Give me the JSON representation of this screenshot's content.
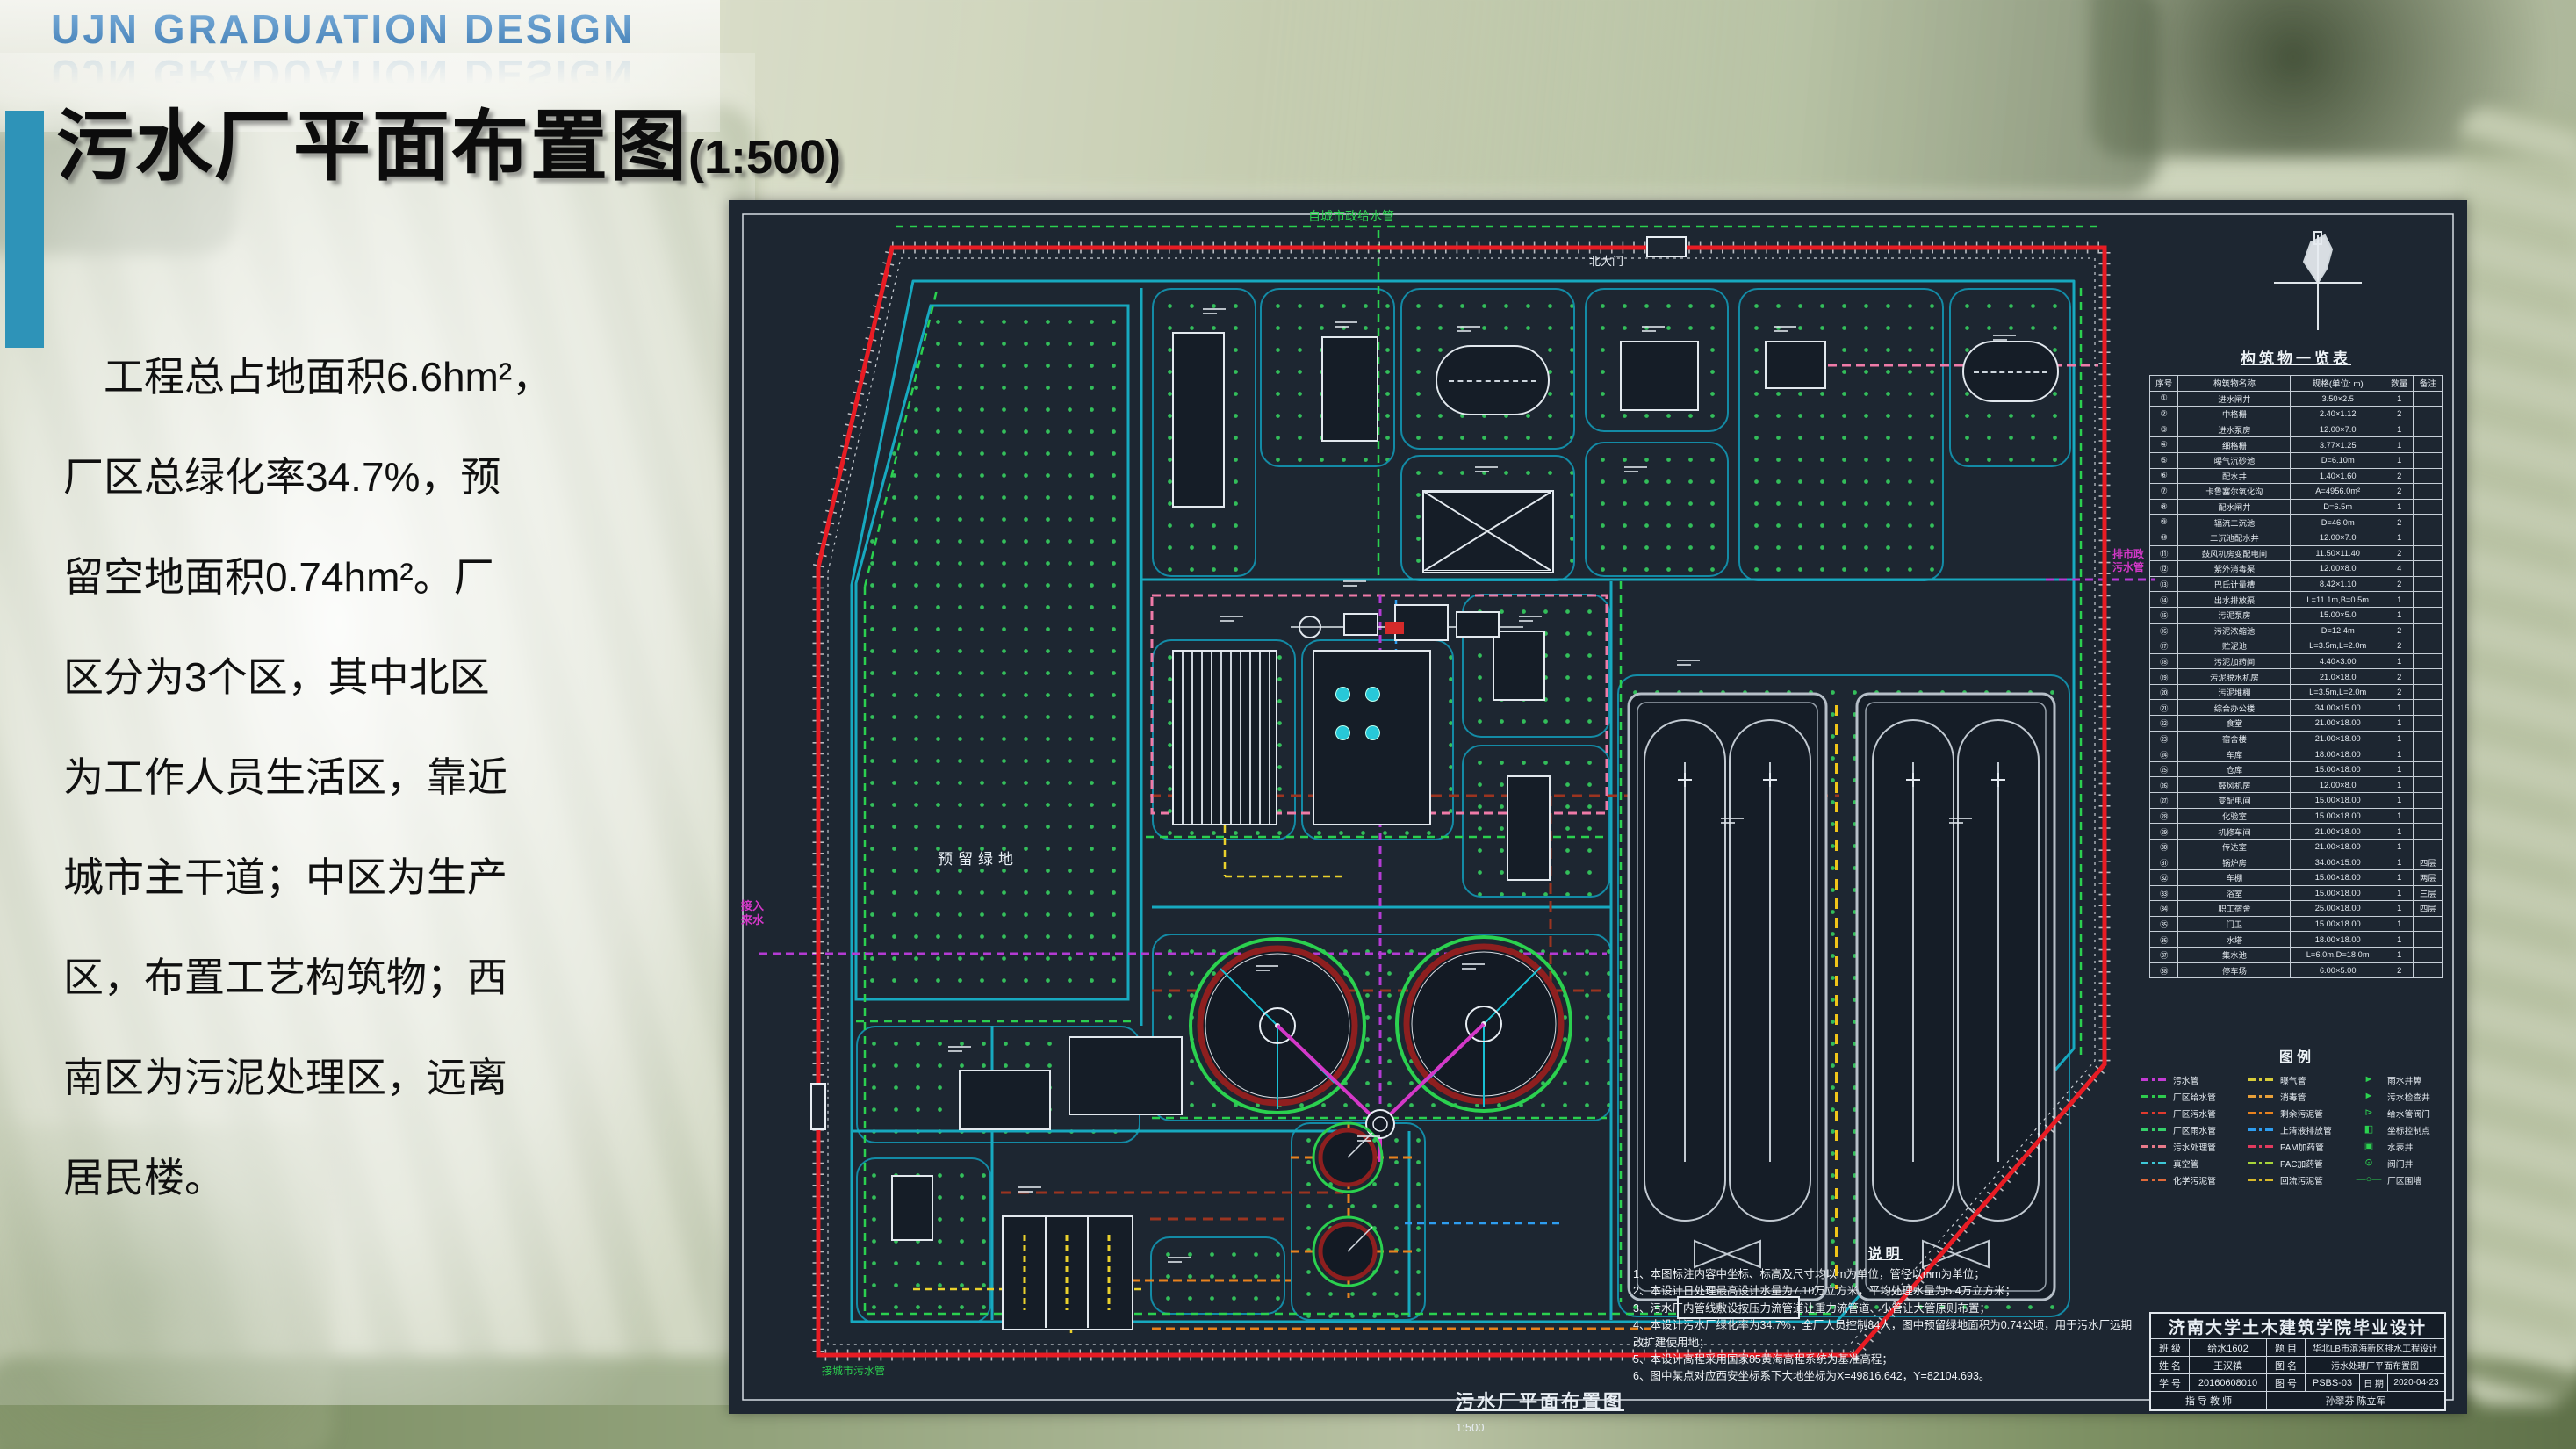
{
  "slide": {
    "header": "UJN GRADUATION DESIGN",
    "title": "污水厂平面布置图",
    "title_scale": "(1:500)",
    "paragraph_lines": [
      "　工程总占地面积6.6hm²，",
      "厂区总绿化率34.7%，预",
      "留空地面积0.74hm²。厂",
      "区分为3个区，其中北区",
      "为工作人员生活区，靠近",
      "城市主干道；中区为生产",
      "区，布置工艺构筑物；西",
      "南区为污泥处理区，远离",
      "居民楼。"
    ]
  },
  "drawing": {
    "labels": {
      "reserved_green": "预留绿地",
      "north_gate": "北大门",
      "inflow": "接入\n来水",
      "outfall": "排市政\n污水管",
      "top_pipe": "自城市政给水管",
      "bottom_pipe": "接城市污水管",
      "bottom_title": "污水厂平面布置图",
      "bottom_scale": "1:500"
    },
    "table": {
      "title": "构筑物一览表",
      "headers": [
        "序号",
        "构筑物名称",
        "规格(单位: m)",
        "数量",
        "备注"
      ],
      "rows": [
        [
          "①",
          "进水闸井",
          "3.50×2.5",
          "1",
          ""
        ],
        [
          "②",
          "中格栅",
          "2.40×1.12",
          "2",
          ""
        ],
        [
          "③",
          "进水泵房",
          "12.00×7.0",
          "1",
          ""
        ],
        [
          "④",
          "细格栅",
          "3.77×1.25",
          "1",
          ""
        ],
        [
          "⑤",
          "曝气沉砂池",
          "D=6.10m",
          "1",
          ""
        ],
        [
          "⑥",
          "配水井",
          "1.40×1.60",
          "2",
          ""
        ],
        [
          "⑦",
          "卡鲁塞尔氧化沟",
          "A=4956.0m²",
          "2",
          ""
        ],
        [
          "⑧",
          "配水闸井",
          "D=6.5m",
          "1",
          ""
        ],
        [
          "⑨",
          "辐流二沉池",
          "D=46.0m",
          "2",
          ""
        ],
        [
          "⑩",
          "二沉池配水井",
          "12.00×7.0",
          "1",
          ""
        ],
        [
          "⑪",
          "鼓风机房变配电间",
          "11.50×11.40",
          "2",
          ""
        ],
        [
          "⑫",
          "紫外消毒渠",
          "12.00×8.0",
          "4",
          ""
        ],
        [
          "⑬",
          "巴氏计量槽",
          "8.42×1.10",
          "2",
          ""
        ],
        [
          "⑭",
          "出水排放渠",
          "L=11.1m,B=0.5m",
          "1",
          ""
        ],
        [
          "⑮",
          "污泥泵房",
          "15.00×5.0",
          "1",
          ""
        ],
        [
          "⑯",
          "污泥浓缩池",
          "D=12.4m",
          "2",
          ""
        ],
        [
          "⑰",
          "贮泥池",
          "L=3.5m,L=2.0m",
          "2",
          ""
        ],
        [
          "⑱",
          "污泥加药间",
          "4.40×3.00",
          "1",
          ""
        ],
        [
          "⑲",
          "污泥脱水机房",
          "21.0×18.0",
          "2",
          ""
        ],
        [
          "⑳",
          "污泥堆棚",
          "L=3.5m,L=2.0m",
          "2",
          ""
        ],
        [
          "㉑",
          "综合办公楼",
          "34.00×15.00",
          "1",
          ""
        ],
        [
          "㉒",
          "食堂",
          "21.00×18.00",
          "1",
          ""
        ],
        [
          "㉓",
          "宿舍楼",
          "21.00×18.00",
          "1",
          ""
        ],
        [
          "㉔",
          "车库",
          "18.00×18.00",
          "1",
          ""
        ],
        [
          "㉕",
          "仓库",
          "15.00×18.00",
          "1",
          ""
        ],
        [
          "㉖",
          "鼓风机房",
          "12.00×8.0",
          "1",
          ""
        ],
        [
          "㉗",
          "变配电间",
          "15.00×18.00",
          "1",
          ""
        ],
        [
          "㉘",
          "化验室",
          "15.00×18.00",
          "1",
          ""
        ],
        [
          "㉙",
          "机修车间",
          "21.00×18.00",
          "1",
          ""
        ],
        [
          "㉚",
          "传达室",
          "21.00×18.00",
          "1",
          ""
        ],
        [
          "㉛",
          "锅炉房",
          "34.00×15.00",
          "1",
          "四层"
        ],
        [
          "㉜",
          "车棚",
          "15.00×18.00",
          "1",
          "两层"
        ],
        [
          "㉝",
          "浴室",
          "15.00×18.00",
          "1",
          "三层"
        ],
        [
          "㉞",
          "职工宿舍",
          "25.00×18.00",
          "1",
          "四层"
        ],
        [
          "㉟",
          "门卫",
          "15.00×18.00",
          "1",
          ""
        ],
        [
          "㊱",
          "水塔",
          "18.00×18.00",
          "1",
          ""
        ],
        [
          "㊲",
          "集水池",
          "L=6.0m,D=18.0m",
          "1",
          ""
        ],
        [
          "㊳",
          "停车场",
          "6.00×5.00",
          "2",
          ""
        ]
      ]
    },
    "legend": {
      "title": "图例",
      "col1": [
        {
          "label": "污水管",
          "color": "#c43bd4"
        },
        {
          "label": "厂区给水管",
          "color": "#2ecc4e"
        },
        {
          "label": "厂区污水管",
          "color": "#e03a2e"
        },
        {
          "label": "厂区雨水管",
          "color": "#35d06a"
        },
        {
          "label": "污水处理管",
          "color": "#e87a8a"
        },
        {
          "label": "真空管",
          "color": "#3ec8d8"
        },
        {
          "label": "化学污泥管",
          "color": "#e06a3a"
        }
      ],
      "col2": [
        {
          "label": "曝气管",
          "color": "#d8cc3a"
        },
        {
          "label": "消毒管",
          "color": "#e8a03a"
        },
        {
          "label": "剩余污泥管",
          "color": "#e8821e"
        },
        {
          "label": "上清液排放管",
          "color": "#2e9df0"
        },
        {
          "label": "PAM加药管",
          "color": "#e03a5e"
        },
        {
          "label": "PAC加药管",
          "color": "#a8d43a"
        },
        {
          "label": "回流污泥管",
          "color": "#d8b82a"
        }
      ],
      "col3": [
        {
          "label": "雨水井箅",
          "glyph": "►"
        },
        {
          "label": "污水检查井",
          "glyph": "►"
        },
        {
          "label": "给水管阀门",
          "glyph": "⊳"
        },
        {
          "label": "坐标控制点",
          "glyph": "◧"
        },
        {
          "label": "水表井",
          "glyph": "▣"
        },
        {
          "label": "阀门井",
          "glyph": "⊙"
        },
        {
          "label": "厂区围墙",
          "glyph": "—○—"
        }
      ]
    },
    "notes": {
      "title": "说明",
      "items": [
        "1、本图标注内容中坐标、标高及尺寸均以m为单位，管径以mm为单位；",
        "2、本设计日处理最高设计水量为7.10万立方米，平均处理水量为5.4万立方米；",
        "3、污水厂内管线敷设按压力流管道让重力流管道、小管让大管原则布置；",
        "4、本设计污水厂绿化率为34.7%，全厂人员控制84人，图中预留绿地面积为0.74公顷，用于污水厂远期改扩建使用地；",
        "5、本设计高程采用国家85黄海高程系统为基准高程；",
        "6、图中某点对应西安坐标系下大地坐标为X=49816.642，Y=82104.693。"
      ]
    },
    "titleblock": {
      "school": "济南大学土木建筑学院毕业设计",
      "class_label": "班 级",
      "class_value": "给水1602",
      "subject_label": "题 目",
      "subject_value": "华北LB市滨海新区排水工程设计",
      "name_label": "姓 名",
      "name_value": "王汉禛",
      "drawing_label": "图 名",
      "drawing_value": "污水处理厂平面布置图",
      "sid_label": "学 号",
      "sid_value": "20160608010",
      "no_label": "图 号",
      "no_value": "PSBS-03",
      "date_label": "日 期",
      "date_value": "2020-04-23",
      "advisor_label": "指 导 教 师",
      "advisor_value": "孙翠芬  陈立军"
    },
    "colors": {
      "accent_bar": "#2e93b8",
      "wall_red": "#e81c24",
      "road_cyan": "#17a9c0",
      "grass_green": "#35c75d",
      "sheet_bg": "#1d2631"
    }
  }
}
